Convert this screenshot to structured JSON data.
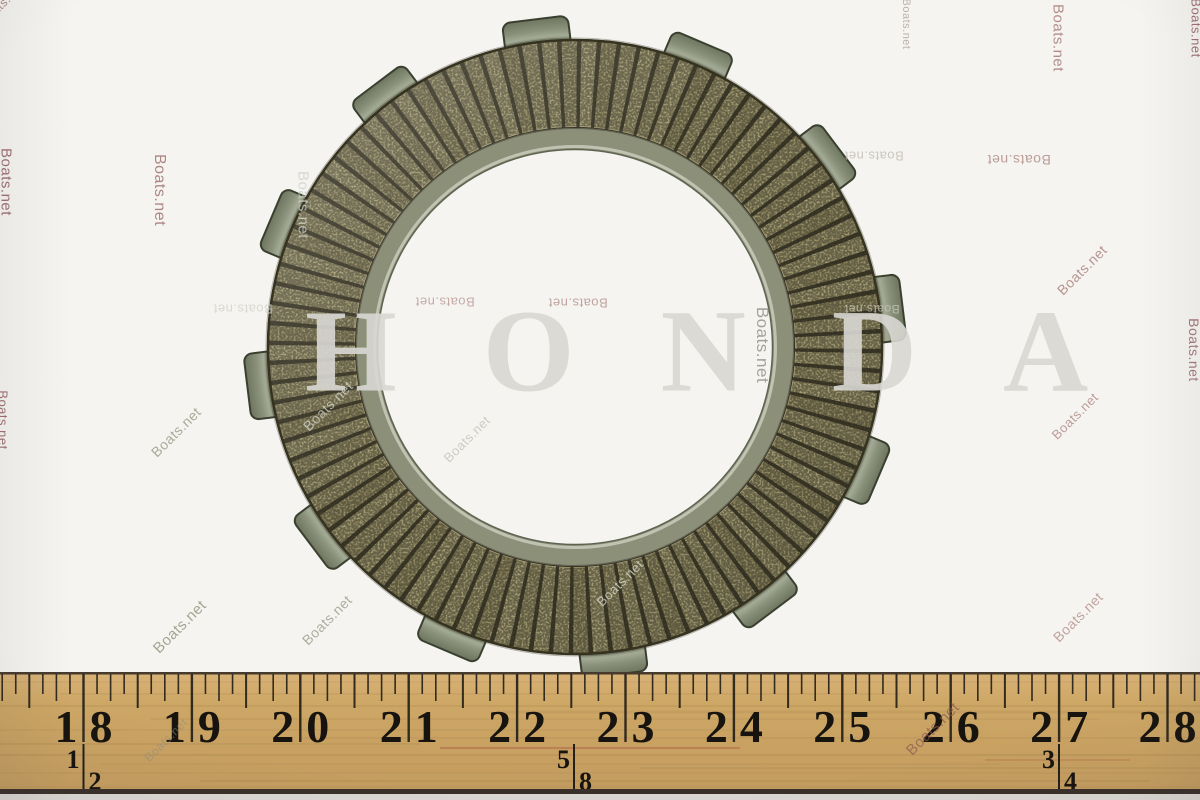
{
  "photo": {
    "subject": "clutch-friction-plate",
    "background_color": "#f5f4f1"
  },
  "ghost_watermark": {
    "text": "HONDA",
    "x": 305,
    "y": 357,
    "font_size": 118,
    "letter_spacing": 86,
    "color": "#d9d8d3",
    "opacity": 0.9
  },
  "watermark_text": "Boats.net",
  "watermarks": [
    {
      "text": "Boats.net",
      "x": 2,
      "y": 4,
      "rot": -45,
      "size": 12,
      "color": "#96625c",
      "opacity": 0.7
    },
    {
      "text": "Boats.net",
      "x": 6,
      "y": 182,
      "rot": 90,
      "size": 15,
      "color": "#8a4f55",
      "opacity": 0.8
    },
    {
      "text": "Boats.net",
      "x": 159,
      "y": 190,
      "rot": 90,
      "size": 16,
      "color": "#96625c",
      "opacity": 0.75
    },
    {
      "text": "Boats.net",
      "x": 303,
      "y": 205,
      "rot": 90,
      "size": 15,
      "color": "#cfd2c6",
      "opacity": 0.8
    },
    {
      "text": "Boats.net",
      "x": 145,
      "y": -8,
      "rot": 180,
      "size": 14,
      "color": "#96625c",
      "opacity": 0.7
    },
    {
      "text": "Boats.net",
      "x": 293,
      "y": -8,
      "rot": 180,
      "size": 14,
      "color": "#96625c",
      "opacity": 0.7
    },
    {
      "text": "Boats.net",
      "x": 590,
      "y": -8,
      "rot": 180,
      "size": 15,
      "color": "#96625c",
      "opacity": 0.7
    },
    {
      "text": "Boats.net",
      "x": 906,
      "y": 24,
      "rot": 90,
      "size": 11,
      "color": "#9c8d85",
      "opacity": 0.65
    },
    {
      "text": "Boats.net",
      "x": 1058,
      "y": 38,
      "rot": 90,
      "size": 15,
      "color": "#96625c",
      "opacity": 0.7
    },
    {
      "text": "Boats.net",
      "x": 1196,
      "y": 28,
      "rot": 90,
      "size": 13,
      "color": "#8a4f55",
      "opacity": 0.8
    },
    {
      "text": "Boats.net",
      "x": 1019,
      "y": 160,
      "rot": 180,
      "size": 14,
      "color": "#96625c",
      "opacity": 0.6
    },
    {
      "text": "Boats.net",
      "x": 874,
      "y": 156,
      "rot": 180,
      "size": 13,
      "color": "#b9b4a6",
      "opacity": 0.7
    },
    {
      "text": "Boats.net",
      "x": 1082,
      "y": 270,
      "rot": -45,
      "size": 14,
      "color": "#96625c",
      "opacity": 0.65
    },
    {
      "text": "Boats.net",
      "x": 762,
      "y": 345,
      "rot": 90,
      "size": 17,
      "color": "#8f8d83",
      "opacity": 0.8
    },
    {
      "text": "Boats.net",
      "x": 872,
      "y": 309,
      "rot": 180,
      "size": 12,
      "color": "#c9c7ba",
      "opacity": 0.8
    },
    {
      "text": "Boats.net",
      "x": 578,
      "y": 303,
      "rot": 180,
      "size": 13,
      "color": "#96625c",
      "opacity": 0.55
    },
    {
      "text": "Boats.net",
      "x": 445,
      "y": 302,
      "rot": 180,
      "size": 13,
      "color": "#96625c",
      "opacity": 0.5
    },
    {
      "text": "Boats.net",
      "x": 243,
      "y": 309,
      "rot": 180,
      "size": 13,
      "color": "#d4d6ca",
      "opacity": 0.85
    },
    {
      "text": "Boats.net",
      "x": 3,
      "y": 420,
      "rot": 90,
      "size": 13,
      "color": "#8a4f55",
      "opacity": 0.8
    },
    {
      "text": "Boats.net",
      "x": 1194,
      "y": 350,
      "rot": 90,
      "size": 14,
      "color": "#8a4f55",
      "opacity": 0.75
    },
    {
      "text": "Boats.net",
      "x": 176,
      "y": 432,
      "rot": -45,
      "size": 14,
      "color": "#8e9379",
      "opacity": 0.75
    },
    {
      "text": "Boats.net",
      "x": 328,
      "y": 406,
      "rot": -45,
      "size": 14,
      "color": "#cfd2c4",
      "opacity": 0.8
    },
    {
      "text": "Boats.net",
      "x": 467,
      "y": 439,
      "rot": -45,
      "size": 13,
      "color": "#b9bdb0",
      "opacity": 0.7
    },
    {
      "text": "Boats.net",
      "x": 620,
      "y": 583,
      "rot": -45,
      "size": 13,
      "color": "#d2d4c6",
      "opacity": 0.85
    },
    {
      "text": "Boats.net",
      "x": 180,
      "y": 627,
      "rot": -45,
      "size": 15,
      "color": "#8e9379",
      "opacity": 0.8
    },
    {
      "text": "Boats.net",
      "x": 327,
      "y": 620,
      "rot": -45,
      "size": 14,
      "color": "#939781",
      "opacity": 0.75
    },
    {
      "text": "Boats.net",
      "x": 1075,
      "y": 416,
      "rot": -45,
      "size": 13,
      "color": "#96625c",
      "opacity": 0.6
    },
    {
      "text": "Boats.net",
      "x": 1078,
      "y": 617,
      "rot": -45,
      "size": 14,
      "color": "#96625c",
      "opacity": 0.55
    },
    {
      "text": "Boats.net",
      "x": 166,
      "y": 740,
      "rot": -45,
      "size": 12,
      "color": "#8f8a7f",
      "opacity": 0.55
    },
    {
      "text": "Boats.net",
      "x": 933,
      "y": 729,
      "rot": -45,
      "size": 15,
      "color": "#8a5a50",
      "opacity": 0.7
    }
  ],
  "plate": {
    "cx": 575,
    "cy": 347,
    "outer_r": 308,
    "pad_inner_r": 219,
    "rim_inner_r": 198,
    "tab_outer_r": 330,
    "tab_count": 12,
    "tab_angle_offset_deg": 97,
    "tab_width_px": 66,
    "pad_count": 96,
    "groove_deg": 0.85,
    "colors": {
      "pads": [
        "#9d9770",
        "#968f69",
        "#a29b74",
        "#918a64",
        "#9a936d"
      ],
      "groove": "#3d3a2a",
      "outer_edge": "#35321f",
      "tab_stroke": "#3a402f",
      "rim": "#8c9079",
      "rim_light": "#c6c9b8",
      "rim_edge": "#5f6450"
    }
  },
  "ruler": {
    "labels": [
      "18",
      "19",
      "20",
      "21",
      "22",
      "23",
      "24",
      "25",
      "26",
      "27",
      "28"
    ],
    "fractions": [
      {
        "top": "1",
        "bottom": "2",
        "x": 83.5
      },
      {
        "top": "5",
        "bottom": "8",
        "x": 574
      },
      {
        "top": "3",
        "bottom": "4",
        "x": 1059
      }
    ],
    "start_x": 83.5,
    "inch_step": 108.4,
    "ticks_per_inch": 8,
    "wood_colors": [
      "#d9b277",
      "#cda765",
      "#c8a162",
      "#c09a5e"
    ],
    "number_color": "#17130e",
    "tick_color": "#241f18"
  }
}
